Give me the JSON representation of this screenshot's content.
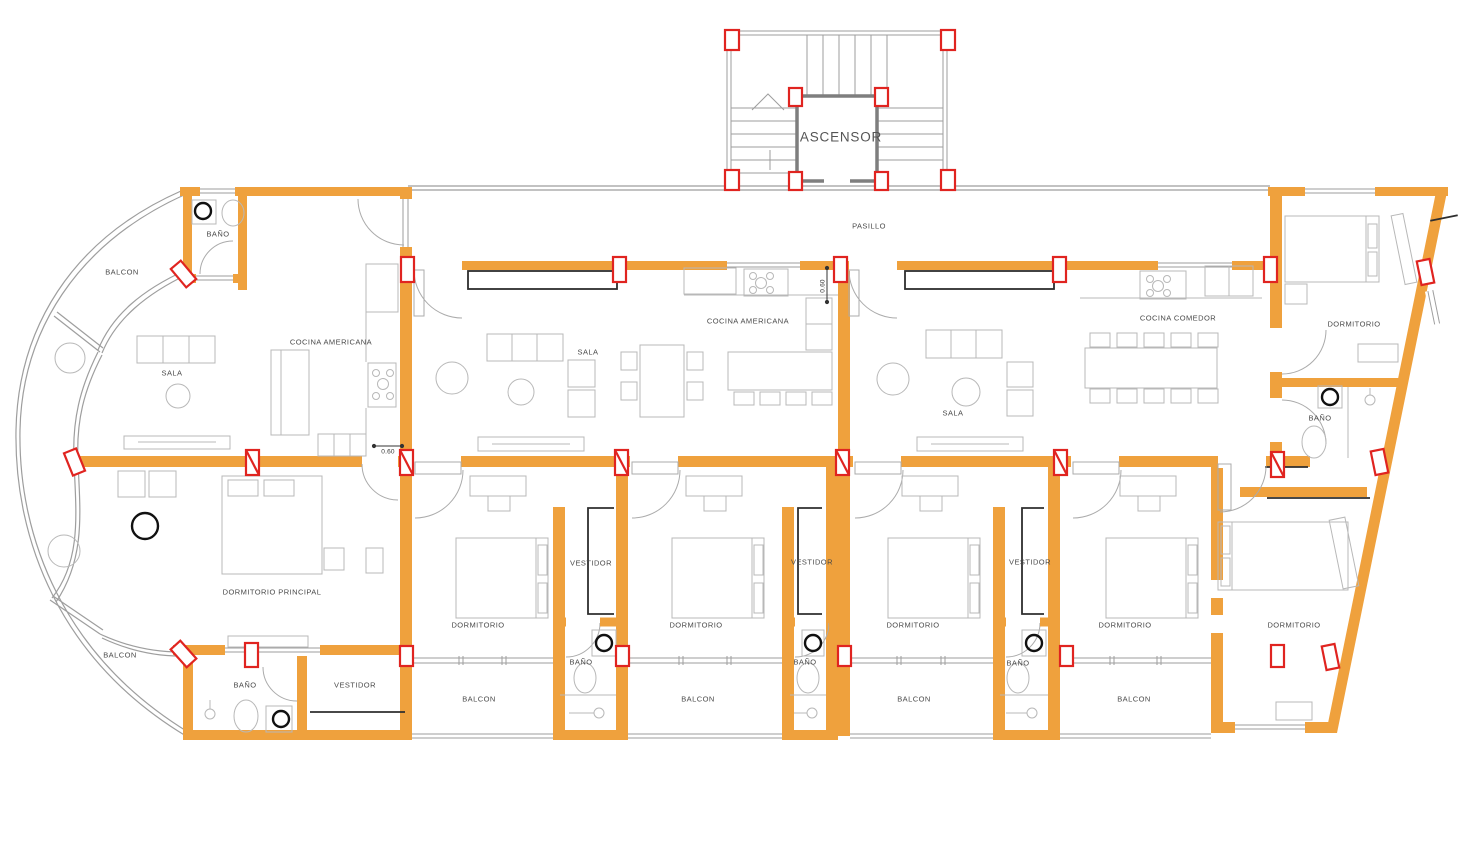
{
  "rooms": [
    {
      "id": "ascensor",
      "text": "ASCENSOR"
    },
    {
      "id": "pasillo",
      "text": "PASILLO"
    },
    {
      "id": "banio-top-left",
      "text": "BAÑO"
    },
    {
      "id": "balcon-top-left",
      "text": "BALCON"
    },
    {
      "id": "cocina-americana-1",
      "text": "COCINA AMERICANA"
    },
    {
      "id": "sala-1",
      "text": "SALA"
    },
    {
      "id": "sala-2",
      "text": "SALA"
    },
    {
      "id": "cocina-americana-2",
      "text": "COCINA AMERICANA"
    },
    {
      "id": "sala-3",
      "text": "SALA"
    },
    {
      "id": "cocina-comedor",
      "text": "COCINA COMEDOR"
    },
    {
      "id": "dormitorio-top-right",
      "text": "DORMITORIO"
    },
    {
      "id": "banio-right",
      "text": "BAÑO"
    },
    {
      "id": "dormitorio-principal",
      "text": "DORMITORIO PRINCIPAL"
    },
    {
      "id": "balcon-bottom-left",
      "text": "BALCON"
    },
    {
      "id": "banio-bottom-left",
      "text": "BAÑO"
    },
    {
      "id": "vestidor-bottom-left",
      "text": "VESTIDOR"
    },
    {
      "id": "dormitorio-1",
      "text": "DORMITORIO"
    },
    {
      "id": "vestidor-1",
      "text": "VESTIDOR"
    },
    {
      "id": "banio-1",
      "text": "BAÑO"
    },
    {
      "id": "balcon-1",
      "text": "BALCON"
    },
    {
      "id": "dormitorio-2",
      "text": "DORMITORIO"
    },
    {
      "id": "vestidor-2",
      "text": "VESTIDOR"
    },
    {
      "id": "banio-2",
      "text": "BAÑO"
    },
    {
      "id": "balcon-2",
      "text": "BALCON"
    },
    {
      "id": "dormitorio-3",
      "text": "DORMITORIO"
    },
    {
      "id": "vestidor-3",
      "text": "VESTIDOR"
    },
    {
      "id": "banio-3",
      "text": "BAÑO"
    },
    {
      "id": "balcon-3",
      "text": "BALCON"
    },
    {
      "id": "dormitorio-4",
      "text": "DORMITORIO"
    },
    {
      "id": "balcon-4",
      "text": "BALCON"
    },
    {
      "id": "dormitorio-5",
      "text": "DORMITORIO"
    }
  ],
  "dimensions": [
    {
      "id": "dim-horizontal",
      "text": "0.60"
    },
    {
      "id": "dim-vertical",
      "text": "0.60"
    }
  ],
  "colors": {
    "wall_orange": "#EFA13D",
    "column_red": "#E02420",
    "line_gray": "#9E9E9E",
    "furniture_gray": "#B8B8B8",
    "dark_line": "#2E2E2E",
    "label_text": "#4A4A4A",
    "background": "#FFFFFF"
  }
}
